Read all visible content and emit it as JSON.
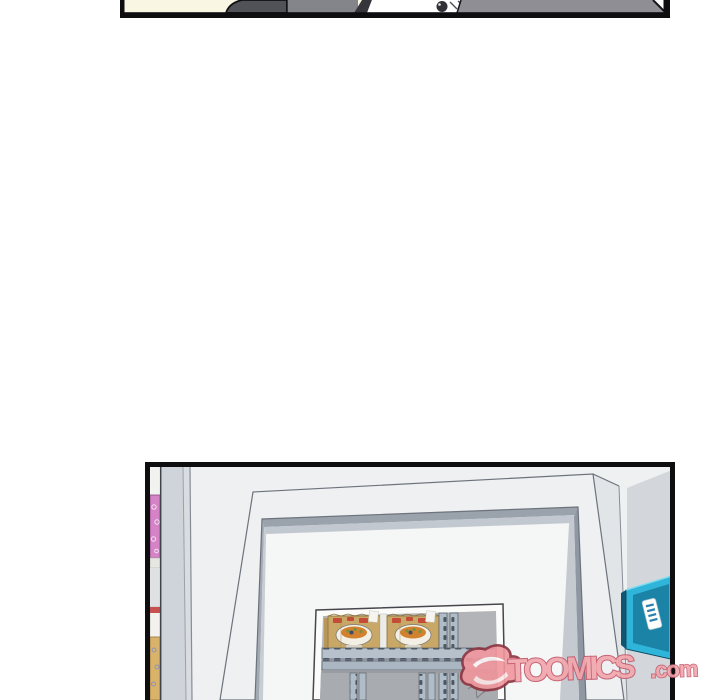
{
  "page": {
    "width": 720,
    "height": 700,
    "background": "#ffffff"
  },
  "watermark": {
    "brand_text": "TOOMICS",
    "suffix_text": ".com",
    "text_fill": "#f2a6ab",
    "text_outline": "#c2556b",
    "logo_icon": "toomics-swoosh-icon",
    "opacity": 0.9
  },
  "panel_top": {
    "label": "comic panel cropped at page top (bottom sliver visible)",
    "background": "#f9f6e3",
    "border_color": "#0e0e10",
    "art_colors": {
      "suit_dark": "#515158",
      "suit_mid": "#84848b",
      "lapel_dark": "#35353b",
      "shirt_white": "#ffffff",
      "button_dark": "#303036",
      "wall_gray": "#8e8e94"
    }
  },
  "panel_store": {
    "label": "convenience-store doorway panel cropped at page bottom",
    "border_color": "#0e0e10",
    "art_colors": {
      "wall_white": "#eef0f1",
      "wall_gray": "#d3d7db",
      "pillar_gray": "#cfd4da",
      "door_frame_white": "#eef0f2",
      "jamb_dark": "#9aa2ac",
      "jamb_light": "#c2c8cf",
      "inner_wall_white": "#f5f6f6",
      "window_bg_gray": "#b2b4b8",
      "shelf_metal_blue": "#b0bcc7",
      "shelf_slot_dark": "#4e5864",
      "noodle_package_tan": "#c9a767",
      "noodle_red_marks": "#c23b30",
      "door_sign_cyan": "#2fb5d9",
      "door_sign_inner": "#1b84a6",
      "door_sign_side": "#11566e",
      "left_shelf_pink": "#d583c6",
      "left_shelf_tan": "#d9b36a",
      "left_box_red": "#c75050"
    }
  }
}
